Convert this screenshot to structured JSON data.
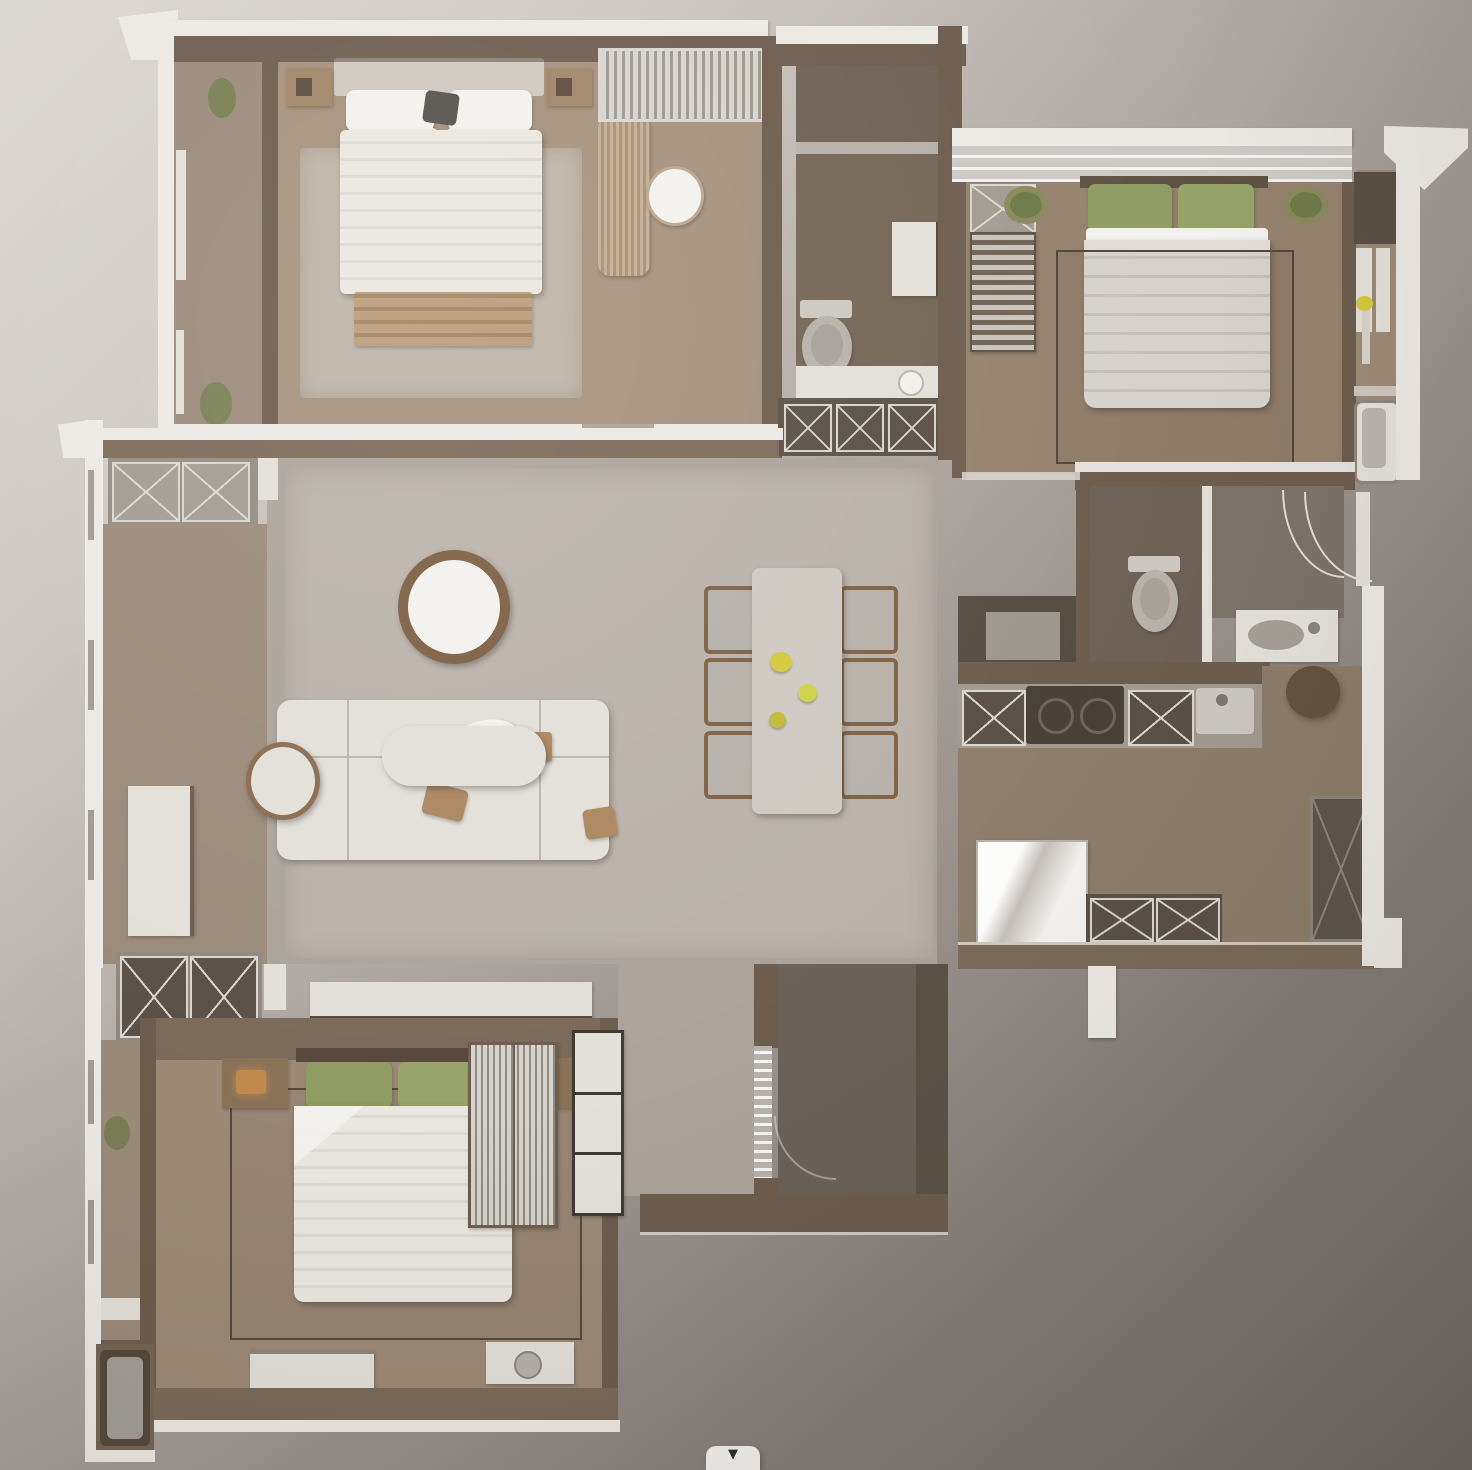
{
  "scene": {
    "kind": "3d-rendered-floor-plan",
    "view": "top-down",
    "text_labels": []
  },
  "colors": {
    "wallWhite": "#ece9e4",
    "wallBrown": "#7b6a59",
    "wallDark": "#6d5d4e",
    "wallDeep": "#5a5147",
    "floorTan": "#a5917c",
    "floorTan2": "#95826d",
    "floorTan3": "#9c8a76",
    "floorBath": "#746656",
    "floorBathDark": "#6e6156",
    "floorLiving": "#aba39b",
    "rugLiving": "#bab2aa",
    "rugBed": "#beb4a8",
    "floorFoyer": "#9a8a7a",
    "floorKitchen": "#8d7d6a",
    "floorTerrace": "#6a6158",
    "furnWhite": "#e3dfd9",
    "furnWhiteBright": "#f3f1ed",
    "wood": "#ab8660",
    "woodDark": "#7e6245",
    "woodDesk": "#b69a7d",
    "greenPillow": "#8f9c62",
    "plantGreen": "#6f7a49",
    "duvetBeige": "#d7d1c8",
    "grayFixture": "#b7b1aa",
    "xDark": "#5a5047",
    "xLight": "#a29b93",
    "frameLight": "#d9d5cf",
    "flowerYellow": "#d2c93c",
    "matDark": "#5e554c",
    "glyphDark": "#2f2b27"
  },
  "rooms": {
    "master_bedroom": {
      "name": "Master Bedroom",
      "furniture": [
        "double-bed",
        "pillows",
        "nightstand-left",
        "nightstand-right",
        "foot-bench",
        "curtain-wardrobe",
        "desk",
        "oval-chair",
        "area-rug",
        "closet-corridor",
        "plants"
      ]
    },
    "bathroom_top": {
      "name": "Bathroom",
      "furniture": [
        "toilet",
        "mirror-cabinet",
        "vanity-sink",
        "x-front-cabinet",
        "laundry-niche"
      ]
    },
    "bedroom_right": {
      "name": "Bedroom 2",
      "furniture": [
        "double-bed",
        "green-pillows",
        "bookshelf",
        "x-front-cabinet",
        "plants",
        "area-rug",
        "flower-vase",
        "bathtub-niche"
      ]
    },
    "living_room": {
      "name": "Living Room",
      "furniture": [
        "sectional-sofa",
        "coffee-table",
        "round-side-table",
        "round-wall-decor",
        "tv-console",
        "throw-blanket",
        "wood-trays",
        "area-rug"
      ]
    },
    "dining_area": {
      "name": "Dining Area",
      "furniture": [
        "dining-table",
        "dining-chairs-x6",
        "yellow-flowers"
      ]
    },
    "kitchen": {
      "name": "Kitchen",
      "furniture": [
        "cooktop",
        "counter-x-cabinets",
        "sink",
        "fridge"
      ]
    },
    "bathroom_right": {
      "name": "Bathroom 2",
      "furniture": [
        "toilet",
        "shower-door-arc",
        "vanity-sink"
      ]
    },
    "powder_room": {
      "name": "Powder Niche",
      "furniture": [
        "dark-vanity",
        "mirror"
      ]
    },
    "entry": {
      "name": "Entry Hall",
      "furniture": [
        "shoe-x-cabinets",
        "door-mat",
        "round-table",
        "entry-door-arc",
        "glass-door"
      ]
    },
    "bedroom_bottom": {
      "name": "Bedroom 3",
      "furniture": [
        "double-bed",
        "green-pillows",
        "lamp-nightstand-left",
        "lamp-nightstand-right",
        "louver-wardrobe",
        "drawer-tower",
        "bench",
        "tray",
        "area-rug"
      ]
    },
    "bathroom_bottom_left": {
      "name": "Bath Nook",
      "furniture": [
        "bathtub",
        "shelf"
      ]
    }
  },
  "ui": {
    "scroll_button_glyph": "▼"
  }
}
